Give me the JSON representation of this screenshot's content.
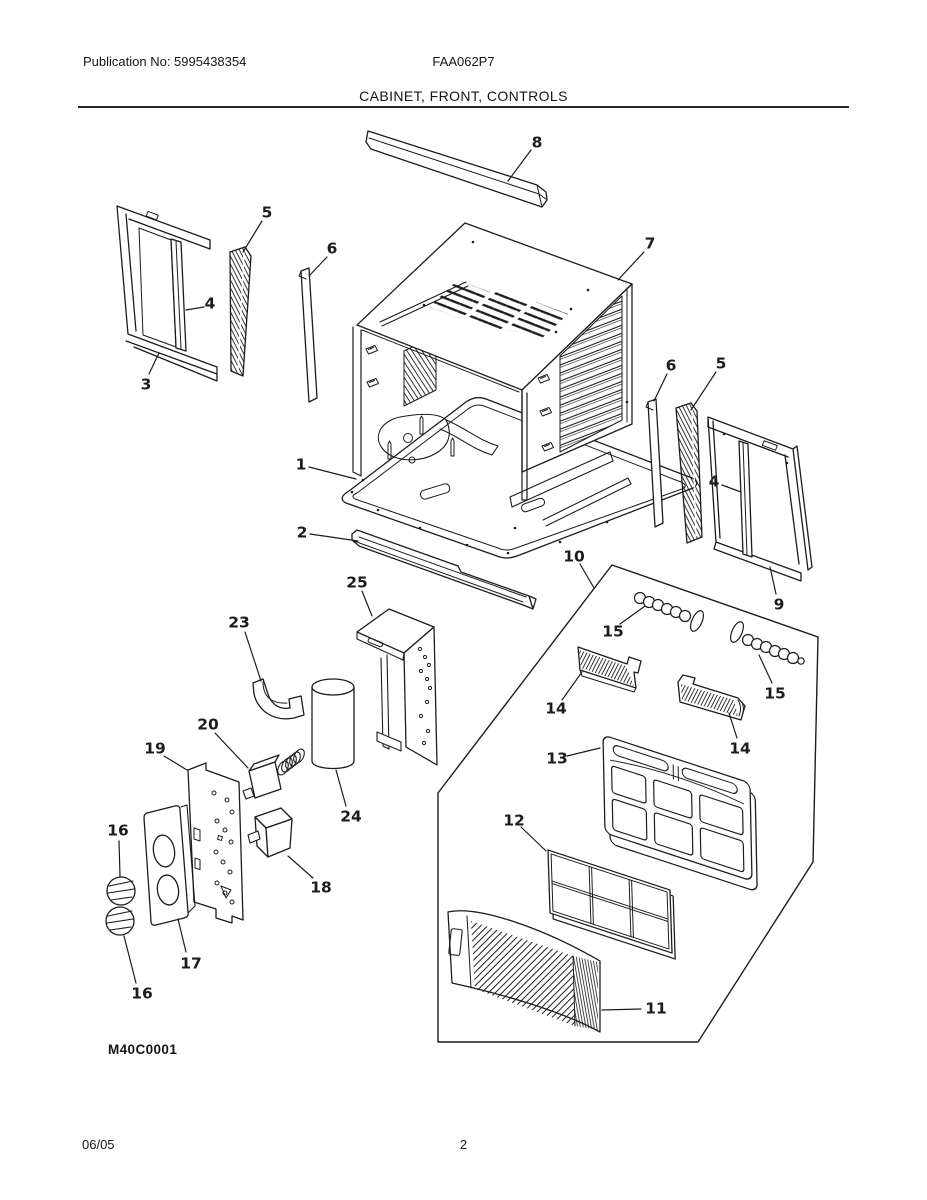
{
  "page": {
    "publication": "Publication No: 5995438354",
    "model": "FAA062P7",
    "section_title": "CABINET, FRONT, CONTROLS",
    "diagram_code": "M40C0001",
    "footer": {
      "date": "06/05",
      "page_number": "2"
    }
  },
  "diagram": {
    "description": "Exploded parts view of room air conditioner cabinet, front and controls",
    "ink": "#1c1c1c",
    "callouts": [
      {
        "part": "8",
        "x": 537,
        "y": 142,
        "leader": [
          531,
          150,
          508,
          181
        ]
      },
      {
        "part": "7",
        "x": 650,
        "y": 243,
        "leader": [
          644,
          252,
          618,
          280
        ]
      },
      {
        "part": "5",
        "x": 267,
        "y": 212,
        "leader": [
          262,
          221,
          243,
          252
        ]
      },
      {
        "part": "6",
        "x": 332,
        "y": 248,
        "leader": [
          327,
          257,
          309,
          276
        ]
      },
      {
        "part": "4",
        "x": 210,
        "y": 303,
        "leader": [
          204,
          307,
          186,
          310
        ]
      },
      {
        "part": "3",
        "x": 146,
        "y": 384,
        "leader": [
          149,
          374,
          159,
          353
        ]
      },
      {
        "part": "1",
        "x": 301,
        "y": 464,
        "leader": [
          309,
          467,
          356,
          479
        ]
      },
      {
        "part": "2",
        "x": 302,
        "y": 532,
        "leader": [
          310,
          534,
          358,
          541
        ]
      },
      {
        "part": "6",
        "x": 671,
        "y": 365,
        "leader": [
          667,
          374,
          654,
          401
        ]
      },
      {
        "part": "5",
        "x": 721,
        "y": 363,
        "leader": [
          716,
          372,
          691,
          410
        ]
      },
      {
        "part": "4",
        "x": 714,
        "y": 481,
        "leader": [
          722,
          485,
          741,
          492
        ]
      },
      {
        "part": "9",
        "x": 779,
        "y": 604,
        "leader": [
          776,
          594,
          770,
          567
        ]
      },
      {
        "part": "10",
        "x": 574,
        "y": 556,
        "leader": [
          580,
          564,
          594,
          588
        ]
      },
      {
        "part": "15",
        "x": 613,
        "y": 631,
        "leader": [
          620,
          624,
          645,
          606
        ]
      },
      {
        "part": "15",
        "x": 775,
        "y": 693,
        "leader": [
          772,
          683,
          759,
          655
        ]
      },
      {
        "part": "14",
        "x": 556,
        "y": 708,
        "leader": [
          562,
          700,
          582,
          672
        ]
      },
      {
        "part": "14",
        "x": 740,
        "y": 748,
        "leader": [
          737,
          738,
          729,
          713
        ]
      },
      {
        "part": "13",
        "x": 557,
        "y": 758,
        "leader": [
          567,
          756,
          600,
          748
        ]
      },
      {
        "part": "12",
        "x": 514,
        "y": 820,
        "leader": [
          521,
          827,
          546,
          851
        ]
      },
      {
        "part": "11",
        "x": 656,
        "y": 1008,
        "leader": [
          641,
          1009,
          602,
          1010
        ]
      },
      {
        "part": "25",
        "x": 357,
        "y": 582,
        "leader": [
          362,
          591,
          372,
          616
        ]
      },
      {
        "part": "23",
        "x": 239,
        "y": 622,
        "leader": [
          245,
          632,
          261,
          681
        ]
      },
      {
        "part": "24",
        "x": 351,
        "y": 816,
        "leader": [
          346,
          806,
          336,
          770
        ]
      },
      {
        "part": "20",
        "x": 208,
        "y": 724,
        "leader": [
          215,
          733,
          248,
          768
        ]
      },
      {
        "part": "19",
        "x": 155,
        "y": 748,
        "leader": [
          164,
          756,
          187,
          770
        ]
      },
      {
        "part": "18",
        "x": 321,
        "y": 887,
        "leader": [
          313,
          878,
          288,
          856
        ]
      },
      {
        "part": "17",
        "x": 191,
        "y": 963,
        "leader": [
          186,
          952,
          178,
          919
        ]
      },
      {
        "part": "16",
        "x": 118,
        "y": 830,
        "leader": [
          119,
          841,
          120,
          876
        ]
      },
      {
        "part": "16",
        "x": 142,
        "y": 993,
        "leader": [
          136,
          983,
          124,
          936
        ]
      }
    ]
  }
}
